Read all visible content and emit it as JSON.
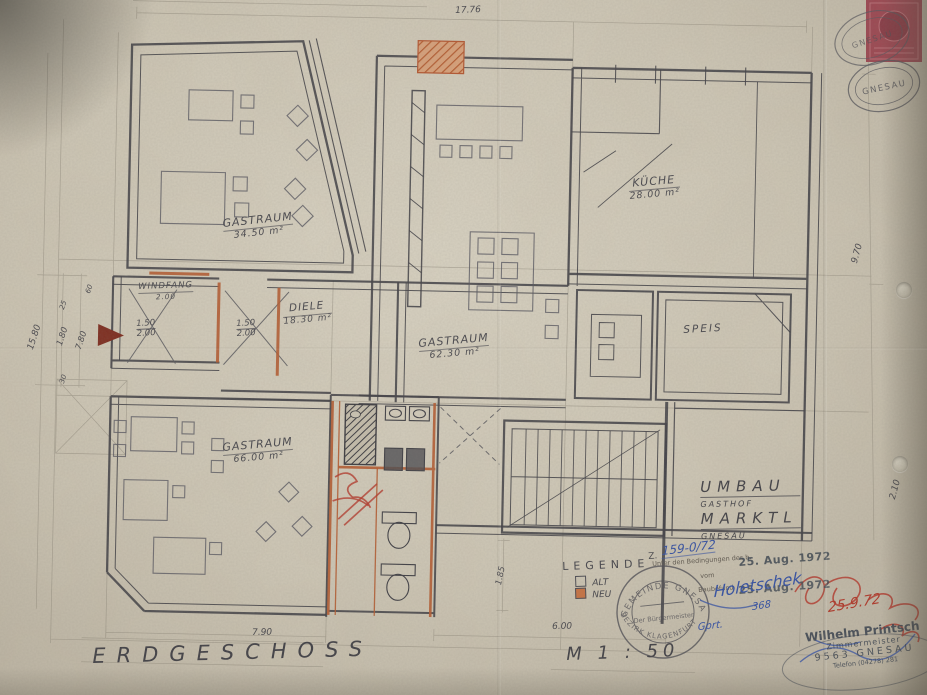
{
  "sheet": {
    "floor_label": "ERDGESCHOSS",
    "scale_label": "M  1 : 50"
  },
  "project": {
    "line1": "UMBAU",
    "line2": "GASTHOF",
    "line3": "MARKTL",
    "line4": "GNESAU"
  },
  "legend": {
    "title": "LEGENDE",
    "alt_label": "ALT",
    "neu_label": "NEU",
    "neu_color": "#c9703f"
  },
  "rooms": [
    {
      "name": "GASTRAUM",
      "area": "34.50 m²"
    },
    {
      "name": "KÜCHE",
      "area": "28.00 m²"
    },
    {
      "name": "SPEIS",
      "area": ""
    },
    {
      "name": "WINDFANG",
      "area": "2.00"
    },
    {
      "name": "DIELE",
      "area": "18.30 m²"
    },
    {
      "name": "GASTRAUM",
      "area": "62.30 m²"
    },
    {
      "name": "GASTRAUM",
      "area": "66.00 m²"
    }
  ],
  "dimensions": {
    "top_width": "17.76",
    "right_height": "9.70",
    "right_lower": "2.10",
    "left_total": "15.80",
    "left_inner": "1.80",
    "left_lower": "7.80",
    "left_small_1": "25",
    "left_small_2": "30",
    "left_small_3": "60",
    "bottom_left": "7.90",
    "bottom_right": "6.00",
    "stair_width": "1.85",
    "door1_width": "1.50",
    "door1_height": "2.00",
    "door2_width": "1.50",
    "door2_height": "2.00"
  },
  "annotations": {
    "file_prefix": "Z.",
    "file_number": "159-0/72",
    "approval_line1": "Unter den Bedingungen des b.",
    "approval_line2": "vom",
    "approval_line3": "Baubefund",
    "date_stamp_1": "25. Aug. 1972",
    "date_stamp_2": "25. Aug. 1972",
    "signature_blue": "Holetschek",
    "signature_blue_number": "368",
    "checked_note": "Gprt.",
    "signature_red_date": "25.9.72"
  },
  "stamps": {
    "ring_top": "GEMEINDE GNESAU",
    "ring_bottom": "BEZIRK KLAGENFURT",
    "ring_center": "Der Bürgermeister",
    "oval_text_1": "GNESAU",
    "oval_text_2": "GNESAU",
    "builder_name": "Wilhelm Printsch",
    "builder_title": "Zimmermeister",
    "builder_city": "9563 GNESAU",
    "builder_phone": "Telefon (04278) 281"
  }
}
